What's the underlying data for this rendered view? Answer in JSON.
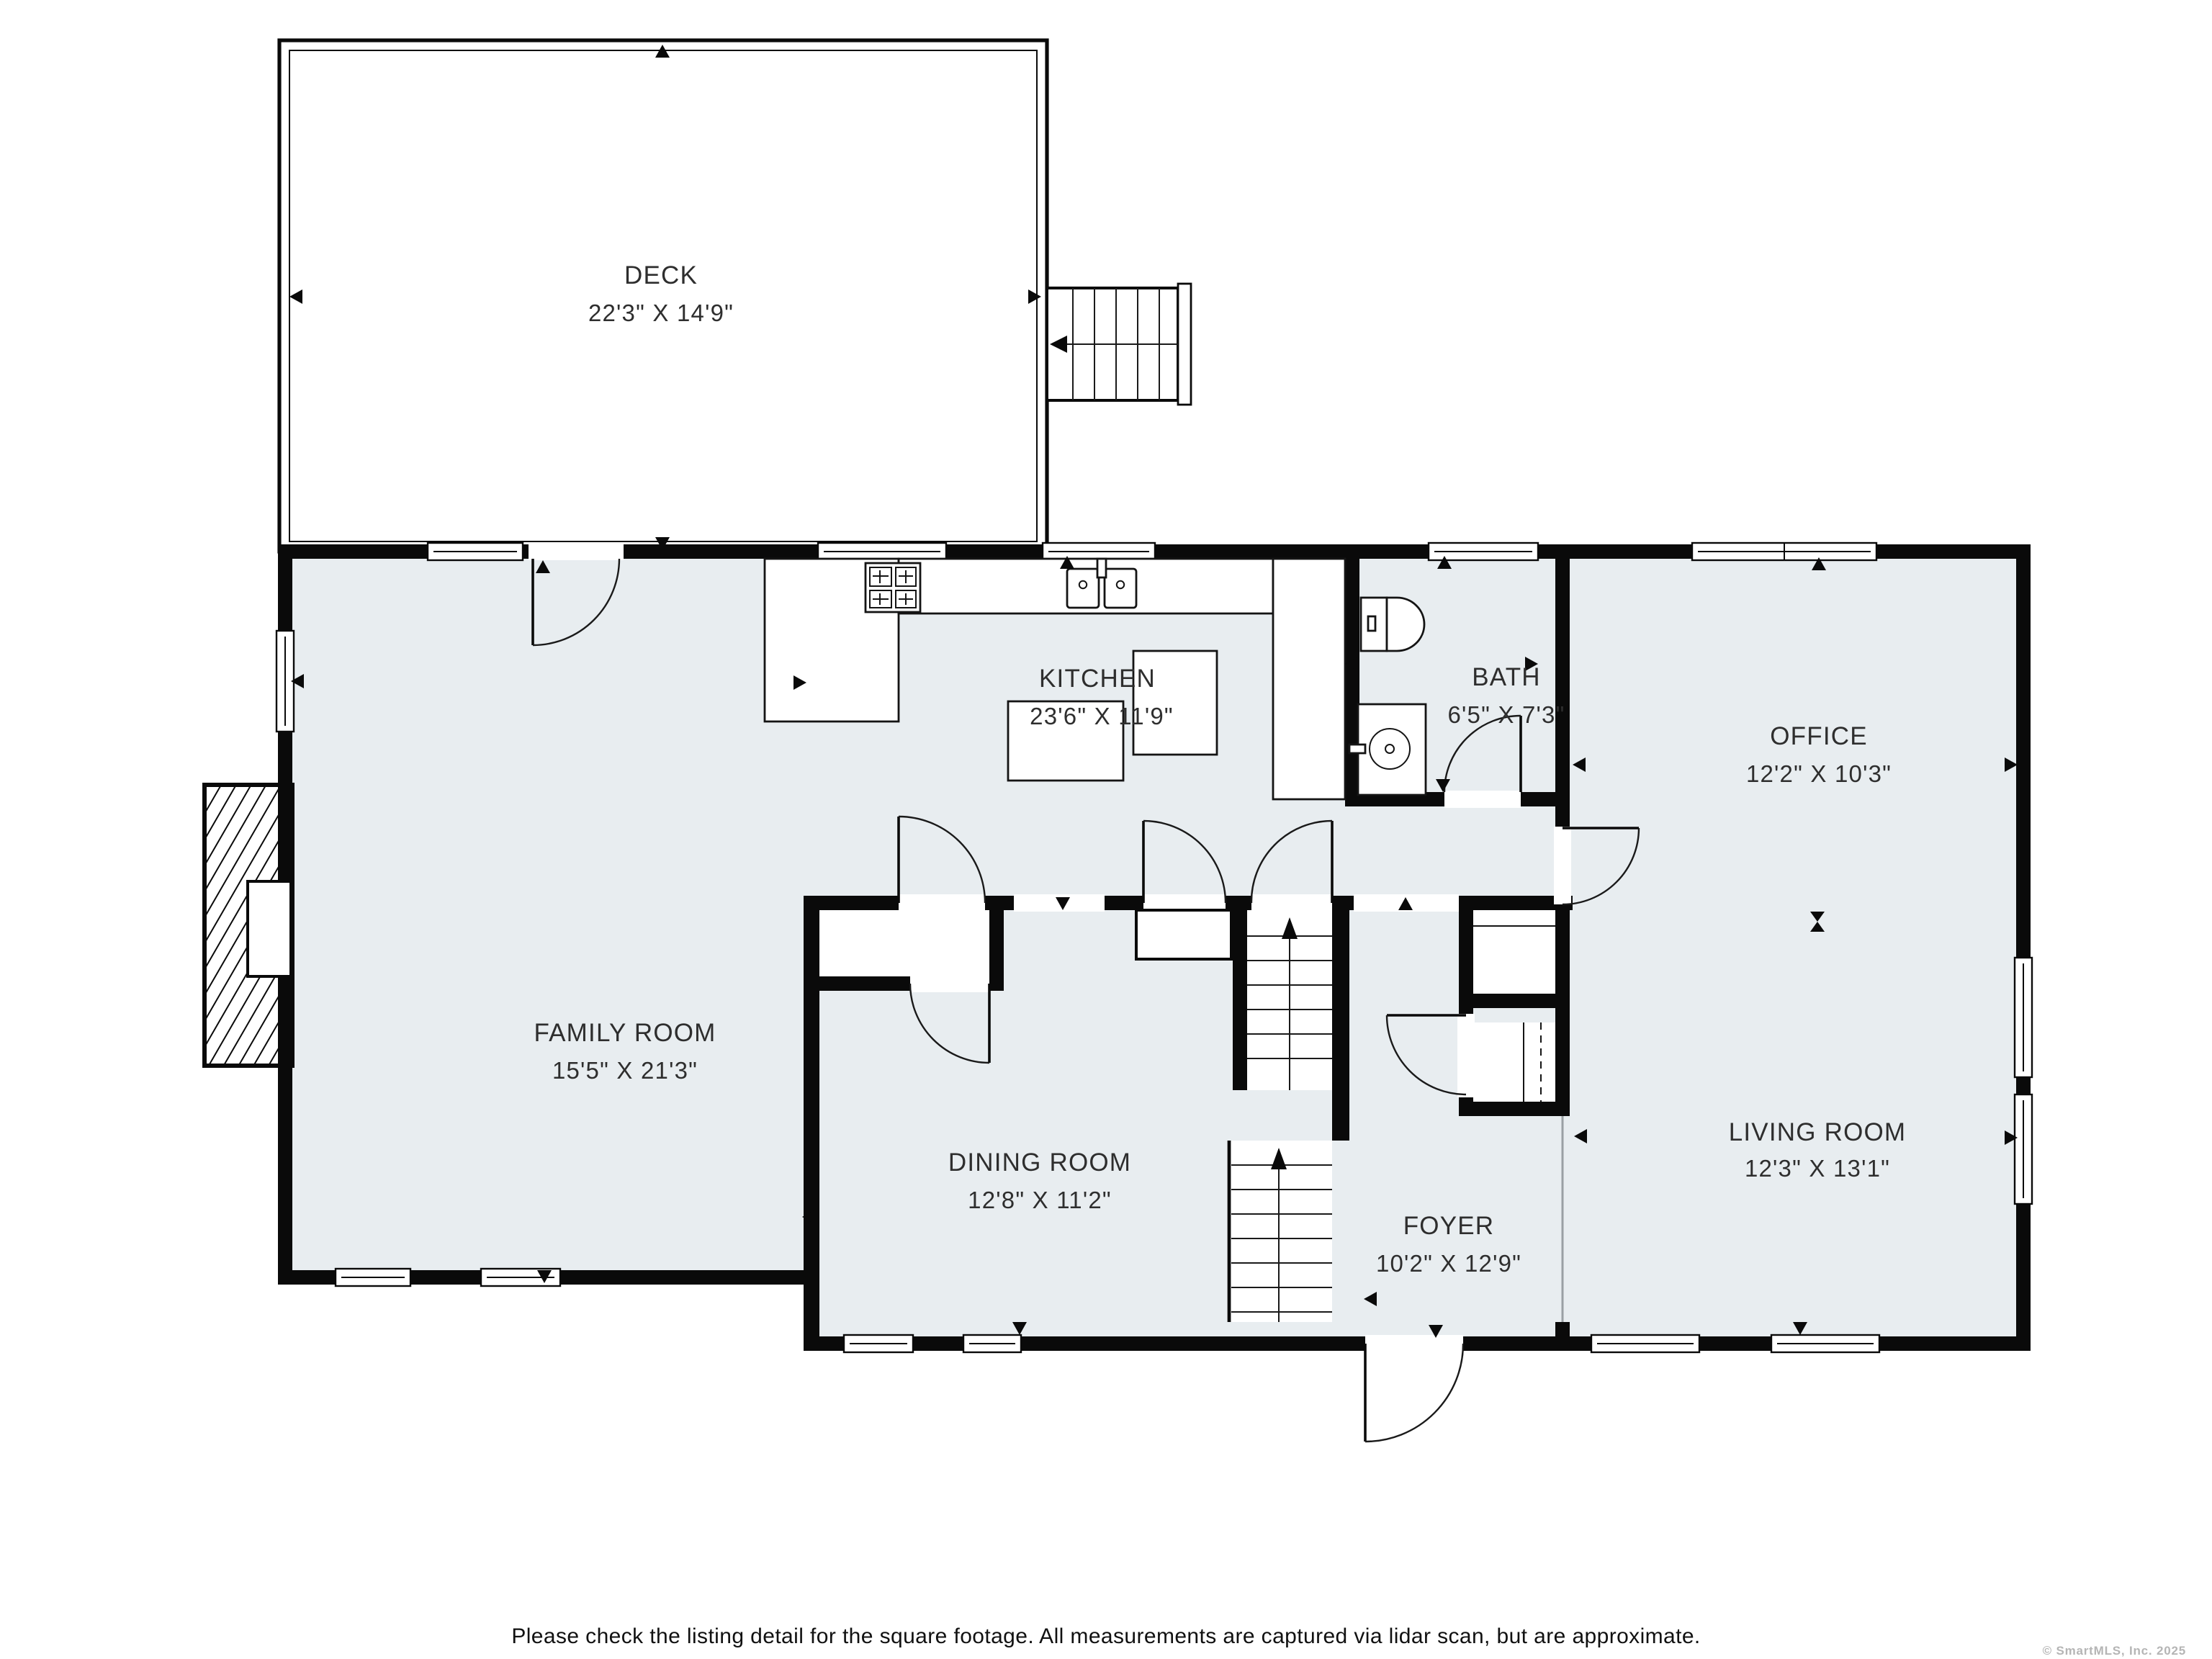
{
  "plan": {
    "floor_color": "#e8edf0",
    "wall_color": "#0a0a0a",
    "label_color": "#2e2e2e",
    "deck_fill": "#ffffff"
  },
  "rooms": [
    {
      "name": "DECK",
      "dims": "22'3\" X 14'9\""
    },
    {
      "name": "KITCHEN",
      "dims": "23'6\" X 11'9\""
    },
    {
      "name": "BATH",
      "dims": "6'5\" X 7'3\""
    },
    {
      "name": "OFFICE",
      "dims": "12'2\" X 10'3\""
    },
    {
      "name": "FAMILY ROOM",
      "dims": "15'5\" X 21'3\""
    },
    {
      "name": "DINING ROOM",
      "dims": "12'8\" X 11'2\""
    },
    {
      "name": "FOYER",
      "dims": "10'2\" X 12'9\""
    },
    {
      "name": "LIVING ROOM",
      "dims": "12'3\" X 13'1\""
    }
  ],
  "footer": {
    "disclaimer": "Please check the listing detail for the square footage. All measurements are captured via lidar scan, but are approximate."
  },
  "copyright": {
    "text": "© SmartMLS, Inc.  2025"
  }
}
